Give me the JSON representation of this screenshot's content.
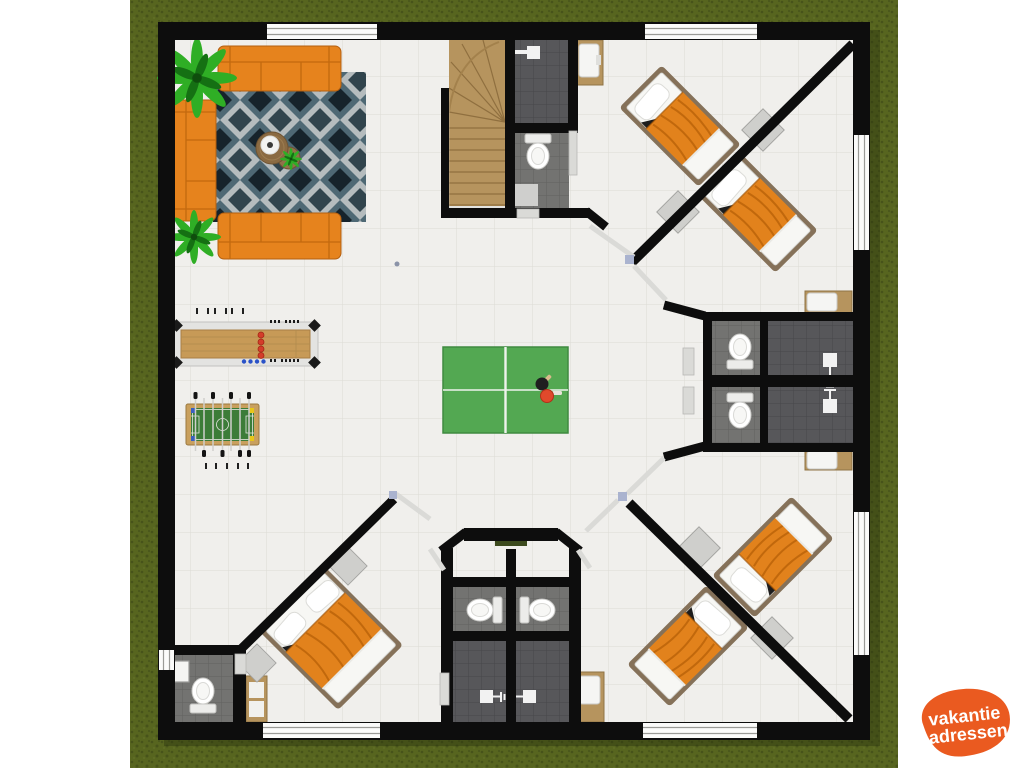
{
  "image": {
    "type": "floor-plan",
    "description": "Top-down 3D rendered ground floor plan of a vacation house on a grass lot: living lounge with orange sofas and geometric rug, central hall with ping-pong table, shuffleboard and foosball tables, staircase, four diagonal bedrooms with orange beds, five bathrooms with toilets and showers"
  },
  "logo": {
    "line1": "vakantie",
    "line2": "adressen"
  },
  "furniture_inventory": [
    "sofa",
    "area-rug",
    "coffee-table",
    "potted-plant",
    "staircase",
    "shuffleboard-table",
    "foosball-table",
    "ping-pong-table",
    "ping-pong-paddle",
    "single-bed",
    "double-bed",
    "nightstand",
    "toilet",
    "shower",
    "sink-vanity",
    "window",
    "door",
    "doormat"
  ],
  "colors": {
    "grass": "#57651f",
    "grass_dark": "#47531a",
    "grass_light": "#68762a",
    "wall": "#0d0d0d",
    "floor": "#f0efec",
    "floor_line": "#dcdbd5",
    "tile_dark": "#57575a",
    "tile_dark_line": "#47474a",
    "tile_mid": "#737371",
    "tile_mid_line": "#616160",
    "wood": "#b6945e",
    "wood_dark": "#8f6f3f",
    "sofa": "#e6831d",
    "sofa_dark": "#c2690e",
    "bed_frame": "#857159",
    "mattress": "#f7f7f4",
    "bed_blanket": "#e2821c",
    "bed_blanket_dark": "#b55f07",
    "rug_base": "#b5bcbe",
    "rug_slate": "#4e6874",
    "rug_dark": "#16232b",
    "rug_mid": "#31444d",
    "pingpong": "#53a852",
    "pingpong_line": "#eef3ec",
    "foosball": "#3c7c38",
    "shuffle_frame": "#e3e3e1",
    "shuffle_lane": "#c79a57",
    "puck_red": "#d43d2a",
    "dot_blue": "#2a52c8",
    "accent_yellow": "#e7c619",
    "accent_blue": "#3a5fc0",
    "plant": "#2fae25",
    "plant_dark": "#157013",
    "nightstand": "#cfcfcc",
    "door": "#dadad7",
    "fixture": "#f2f2f2",
    "window": "#fbfbfa",
    "window_frame": "#9a9a96",
    "doormat": "#3c4a1d",
    "hinge": "#aab3cf",
    "logo_orange": "#ea5a20",
    "logo_text": "#ffffff"
  }
}
